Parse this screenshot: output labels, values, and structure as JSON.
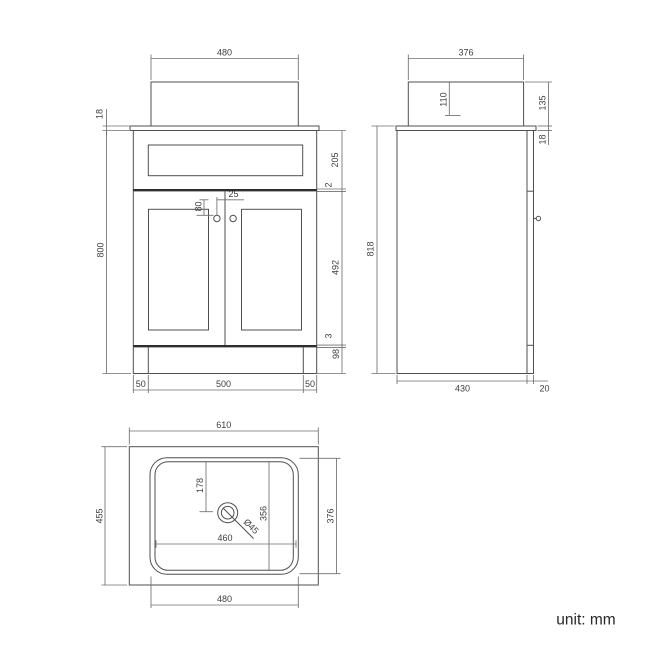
{
  "unit_label": "unit: mm",
  "front": {
    "basin_width": "480",
    "worktop_thickness": "18",
    "cabinet_height": "800",
    "drawer_height": "205",
    "top_gap": "2",
    "handle_drop": "80",
    "handle_inset": "25",
    "door_height": "492",
    "bottom_gap": "3",
    "plinth_height": "98",
    "left_stile": "50",
    "opening_width": "500",
    "right_stile": "50"
  },
  "side": {
    "basin_depth": "376",
    "basin_inner_depth": "110",
    "basin_height": "135",
    "worktop_thickness": "18",
    "total_height": "818",
    "cabinet_depth": "430",
    "door_thickness": "20"
  },
  "top": {
    "worktop_width": "610",
    "worktop_depth": "455",
    "drain_setback": "178",
    "bowl_inner_depth": "356",
    "bowl_outer_depth": "376",
    "bowl_inner_width": "460",
    "drain_diameter": "Ø45",
    "bowl_outer_width": "480"
  }
}
